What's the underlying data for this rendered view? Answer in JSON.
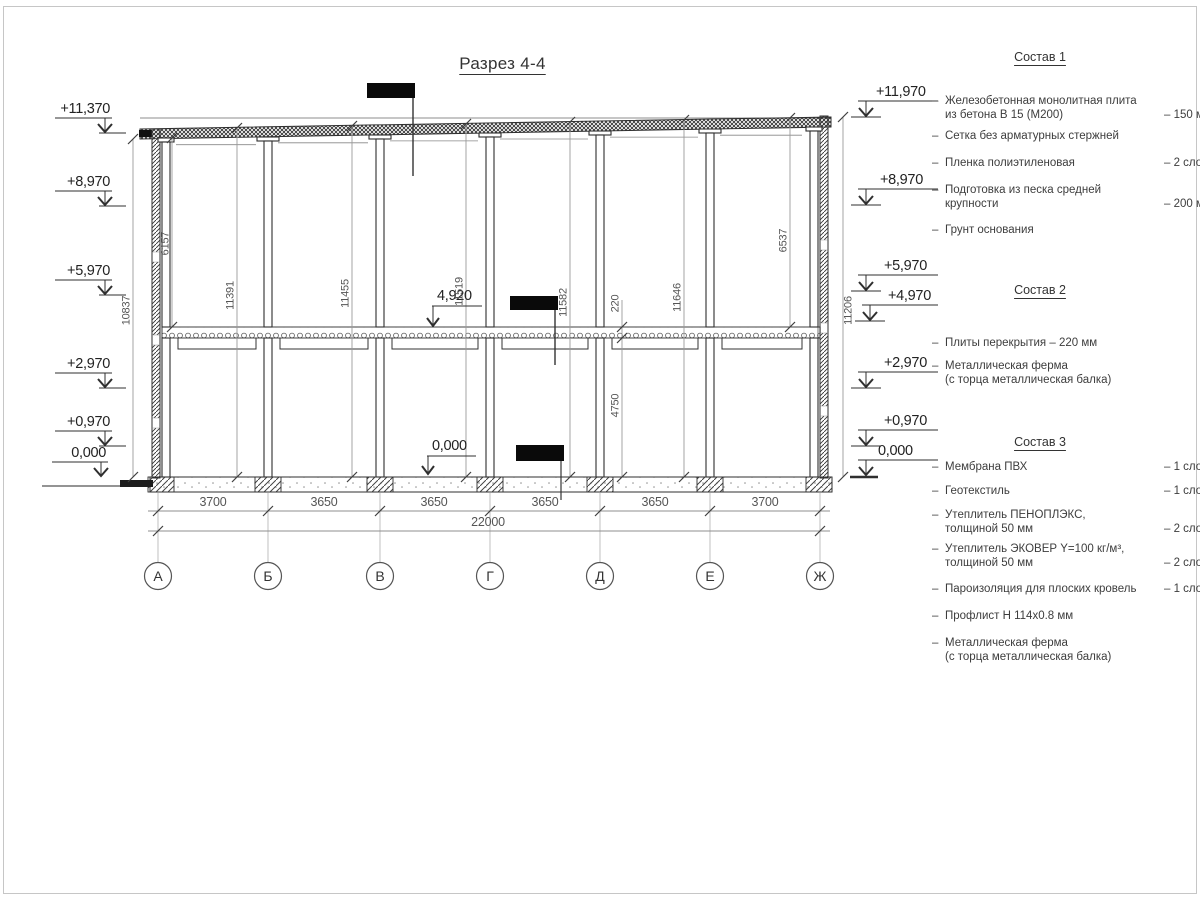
{
  "title": "Разрез 4-4",
  "marks_left": [
    "+11,370",
    "+8,970",
    "+5,970",
    "+2,970",
    "+0,970",
    "0,000"
  ],
  "marks_right": [
    "+11,970",
    "+8,970",
    "+5,970",
    "+4,970",
    "+2,970",
    "+0,970",
    "0,000"
  ],
  "marks_inner": [
    "4,920",
    "0,000"
  ],
  "vdims": [
    "10837",
    "6157",
    "11391",
    "11455",
    "11519",
    "11582",
    "220",
    "11646",
    "6537",
    "11206",
    "4750"
  ],
  "hdims": [
    "3700",
    "3650",
    "3650",
    "3650",
    "3650",
    "3700"
  ],
  "total": "22000",
  "axes": [
    "А",
    "Б",
    "В",
    "Г",
    "Д",
    "Е",
    "Ж"
  ],
  "legend": {
    "s1": {
      "title": "Состав 1",
      "items": [
        {
          "b": "–",
          "t": "Железобетонная  монолитная плита\nиз бетона В 15 (М200)",
          "v": "– 150 мм"
        },
        {
          "b": "–",
          "t": "Сетка без арматурных стержней"
        },
        {
          "b": "–",
          "t": "Пленка полиэтиленовая",
          "v": "– 2 слоя"
        },
        {
          "b": "–",
          "t": "Подготовка из песка средней\nкрупности",
          "v": "– 200 мм"
        },
        {
          "b": "–",
          "t": "Грунт основания"
        }
      ]
    },
    "s2": {
      "title": "Состав 2",
      "items": [
        {
          "b": "–",
          "t": "Плиты перекрытия – 220 мм"
        },
        {
          "b": "–",
          "t": "Металлическая ферма\n(с торца металлическая балка)"
        }
      ]
    },
    "s3": {
      "title": "Состав 3",
      "items": [
        {
          "b": "–",
          "t": "Мембрана ПВХ",
          "v": "– 1 слой"
        },
        {
          "b": "–",
          "t": "Геотекстиль",
          "v": "– 1 слой"
        },
        {
          "b": "–",
          "t": "Утеплитель ПЕНОПЛЭКС,\nтолщиной 50 мм",
          "v": "– 2 слоя"
        },
        {
          "b": "–",
          "t": "Утеплитель ЭКОВЕР Y=100 кг/м³,\nтолщиной 50 мм",
          "v": "– 2 слоя"
        },
        {
          "b": "–",
          "t": "Пароизоляция для плоских кровель",
          "v": "– 1 слой"
        },
        {
          "b": "–",
          "t": "Профлист Н 114х0.8 мм"
        },
        {
          "b": "–",
          "t": "Металлическая ферма\n(с торца металлическая балка)"
        }
      ]
    }
  }
}
